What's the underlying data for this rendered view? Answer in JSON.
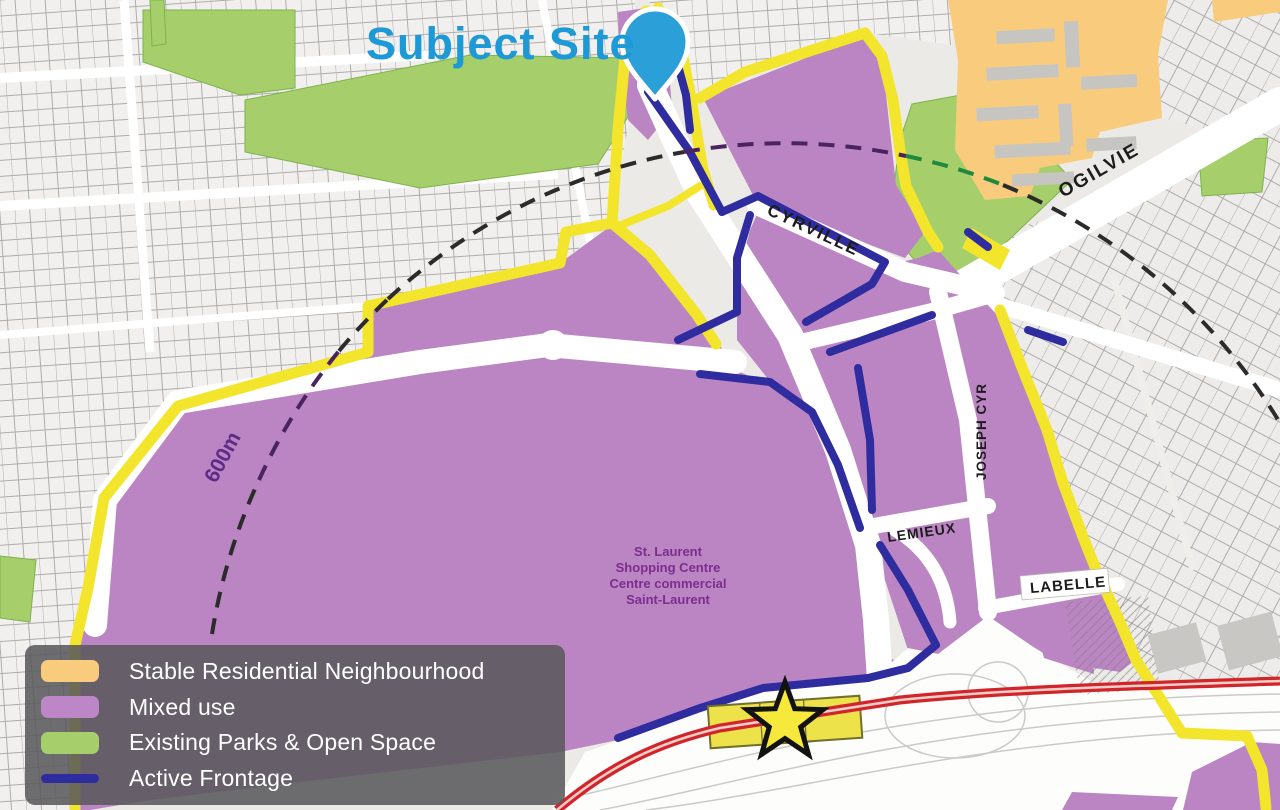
{
  "title": {
    "subject_site": "Subject Site"
  },
  "legend": {
    "items": [
      {
        "id": "stable-residential",
        "label": "Stable Residential Neighbourhood",
        "color": "#F8CB7D"
      },
      {
        "id": "mixed-use",
        "label": "Mixed use",
        "color": "#BD86C6"
      },
      {
        "id": "parks-open-space",
        "label": "Existing Parks & Open Space",
        "color": "#A6CF6C"
      },
      {
        "id": "active-frontage",
        "label": "Active Frontage",
        "color": "#2E2C9E"
      }
    ]
  },
  "map": {
    "street_labels": {
      "cyrville": "CYRVILLE",
      "ogilvie": "OGILVIE",
      "joseph_cyr": "JOSEPH CYR",
      "lemieux": "LEMIEUX",
      "labelle": "LABELLE"
    },
    "place_label": {
      "line1": "St. Laurent",
      "line2": "Shopping Centre",
      "line3": "Centre commercial",
      "line4": "Saint-Laurent"
    },
    "radius_label": "600m",
    "markers": {
      "subject_site_pin": "map-pin-icon",
      "transit_station": "star-icon"
    }
  },
  "colors": {
    "accent_blue": "#1C99D6",
    "pin_blue": "#2BA0D8",
    "mixed_use_purple": "#BB85C4",
    "stable_residential_orange": "#F8CB7D",
    "parks_green": "#A6CF6C",
    "active_frontage_navy": "#2E2C9E",
    "boundary_yellow": "#F3E52B",
    "transit_red": "#D2252B",
    "star_yellow": "#F7E93B",
    "place_label_purple": "#7B2E8E"
  }
}
